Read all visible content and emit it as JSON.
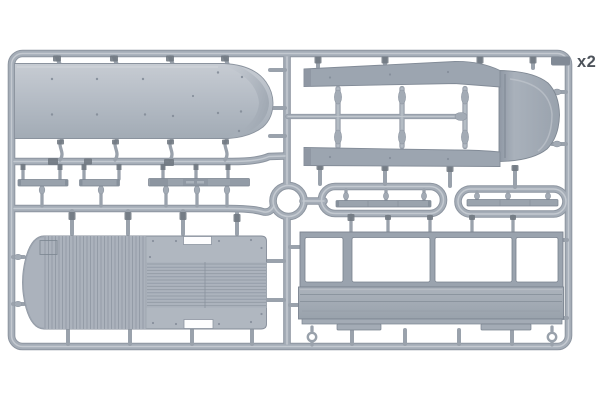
{
  "scene": {
    "description": "Injection-molded plastic model sprue with gray parts for a bus/tram model kit photographed on a white background",
    "quantity_label": "x2"
  },
  "colors": {
    "background": "#ffffff",
    "plastic_base": "#a5adb7",
    "plastic_shadow": "#8d95a0",
    "plastic_highlight": "#c9ced5",
    "part_fill": "#9aa3ae",
    "window_opening": "#ffffff",
    "label_text": "#4d535b"
  },
  "parts": [
    {
      "name": "roof-panel",
      "position": "top-left"
    },
    {
      "name": "roof-frame-with-front-cap",
      "position": "top-right"
    },
    {
      "name": "ribbed-floor-panel",
      "position": "bottom-left"
    },
    {
      "name": "side-wall-with-windows",
      "position": "bottom-right"
    },
    {
      "name": "thin-strip-parts",
      "position": "middle-row"
    },
    {
      "name": "runner-ring",
      "position": "center"
    }
  ],
  "windows": {
    "count": 4
  }
}
